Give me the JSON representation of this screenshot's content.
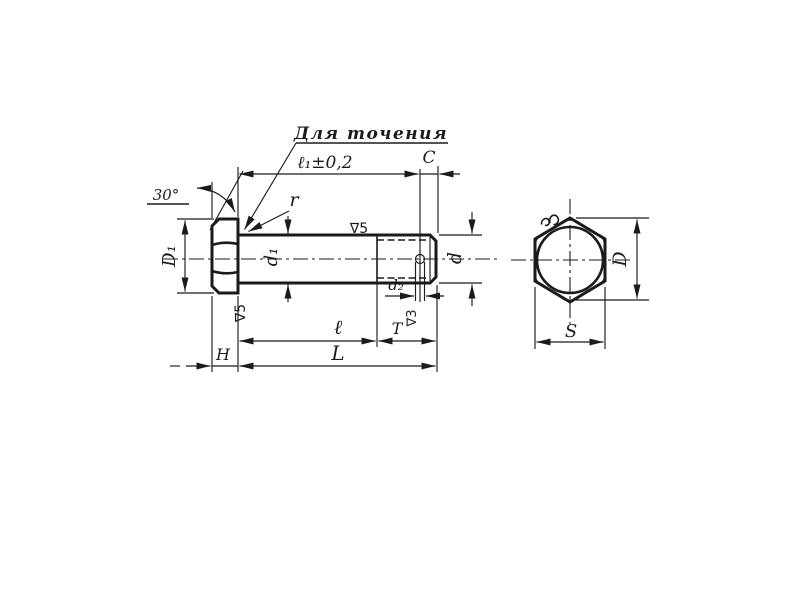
{
  "front_view": {
    "callout_label": "Для точения",
    "dim_l1": "ℓ₁±0,2",
    "dim_c": "C",
    "dim_angle": "30°",
    "dim_r": "r",
    "dim_D1": "D₁",
    "dim_d1": "d₁",
    "dim_d": "d",
    "dim_d2": "d₂",
    "dim_l": "ℓ",
    "dim_T": "T",
    "dim_H": "H",
    "dim_L": "L",
    "surface_shank": "∇5",
    "surface_head": "∇5",
    "surface_thread": "∇3"
  },
  "end_view": {
    "dim_D": "D",
    "dim_S": "S"
  },
  "colors": {
    "ink": "#1b1b1b",
    "paper": "#ffffff"
  }
}
